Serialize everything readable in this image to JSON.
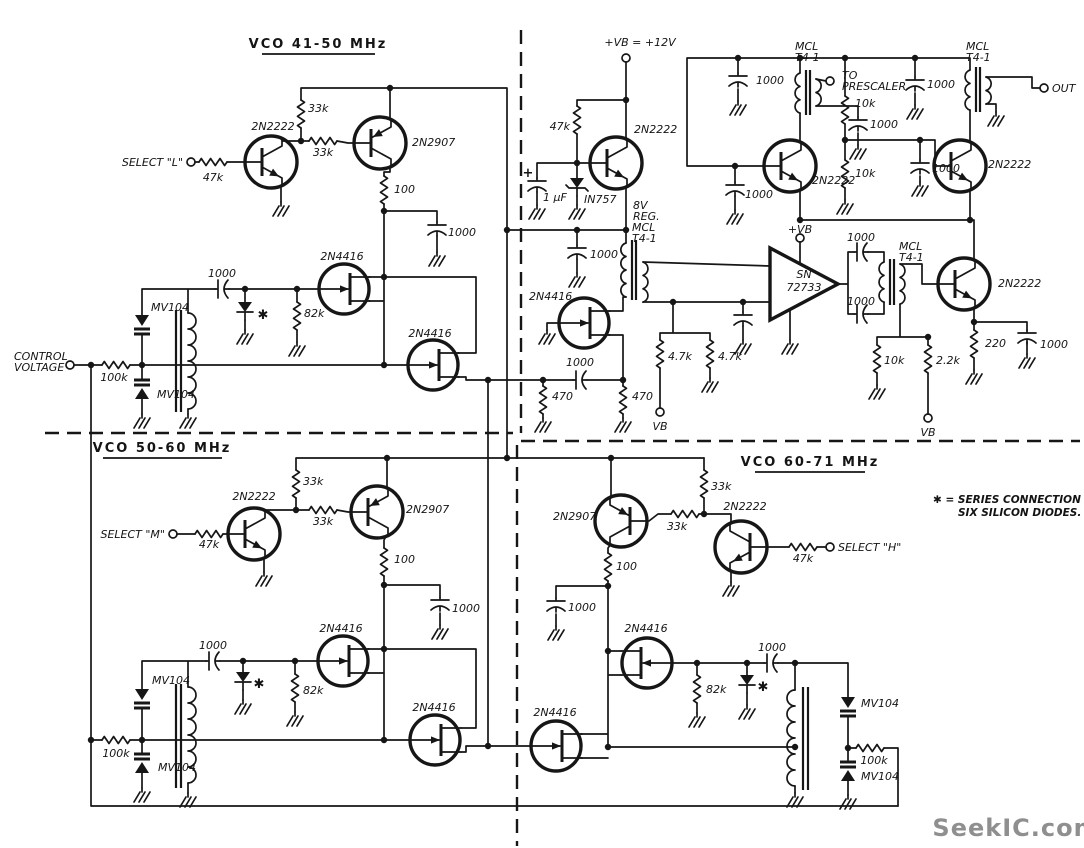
{
  "diagram": {
    "type": "schematic",
    "description": "Three-range VCO circuit schematic (41-50 MHz, 50-60 MHz, 60-71 MHz) with buffer/output stages",
    "watermark_color": "#8f8f8f",
    "ink_color": "#161616"
  },
  "labels": [
    {
      "n": "vco1-title",
      "t": "VCO   41-50 MHz",
      "x": 318,
      "y": 48,
      "a": "m",
      "c": "title"
    },
    {
      "n": "vco2-title",
      "t": "VCO   50-60 MHz",
      "x": 162,
      "y": 452,
      "a": "m",
      "c": "title"
    },
    {
      "n": "vco3-title",
      "t": "VCO   60-71 MHz",
      "x": 810,
      "y": 466,
      "a": "m",
      "c": "title"
    },
    {
      "n": "note-line1",
      "t": "✱ = SERIES CONNECTION OF",
      "x": 933,
      "y": 503,
      "c": "note"
    },
    {
      "n": "note-line2",
      "t": "SIX SILICON DIODES.",
      "x": 958,
      "y": 516,
      "c": "note"
    },
    {
      "n": "select-l-label",
      "t": "SELECT \"L\"",
      "x": 183,
      "y": 166,
      "a": "e"
    },
    {
      "n": "select-m-label",
      "t": "SELECT \"M\"",
      "x": 165,
      "y": 538,
      "a": "e"
    },
    {
      "n": "select-h-label",
      "t": "SELECT \"H\"",
      "x": 838,
      "y": 551
    },
    {
      "n": "control-voltage-line1",
      "t": "CONTROL",
      "x": 14,
      "y": 360
    },
    {
      "n": "control-voltage-line2",
      "t": "VOLTAGE",
      "x": 14,
      "y": 371
    },
    {
      "n": "to-prescaler-line1",
      "t": "TO",
      "x": 842,
      "y": 79
    },
    {
      "n": "to-prescaler-line2",
      "t": "PRESCALER",
      "x": 842,
      "y": 90
    },
    {
      "n": "out-label",
      "t": "OUT",
      "x": 1052,
      "y": 92
    },
    {
      "n": "supply-label",
      "t": "+VB = +12V",
      "x": 640,
      "y": 46,
      "a": "m"
    },
    {
      "n": "opamp-vb-label",
      "t": "+VB",
      "x": 800,
      "y": 233,
      "a": "m"
    },
    {
      "n": "vb-label-1",
      "t": "VB",
      "x": 660,
      "y": 430,
      "a": "m"
    },
    {
      "n": "vb-label-2",
      "t": "VB",
      "x": 928,
      "y": 436,
      "a": "m"
    },
    {
      "n": "reg-label-line1",
      "t": "8V",
      "x": 633,
      "y": 209
    },
    {
      "n": "reg-label-line2",
      "t": "REG.",
      "x": 633,
      "y": 220
    },
    {
      "n": "r-47k-vco1",
      "t": "47k",
      "x": 213,
      "y": 181,
      "a": "m"
    },
    {
      "n": "q-2n2222-vco1",
      "t": "2N2222",
      "x": 273,
      "y": 130,
      "a": "m"
    },
    {
      "n": "r-33k-a-vco1",
      "t": "33k",
      "x": 308,
      "y": 112
    },
    {
      "n": "r-33k-b-vco1",
      "t": "33k",
      "x": 323,
      "y": 156,
      "a": "m"
    },
    {
      "n": "q-2n2907-vco1",
      "t": "2N2907",
      "x": 412,
      "y": 146
    },
    {
      "n": "r-100-vco1",
      "t": "100",
      "x": 394,
      "y": 193
    },
    {
      "n": "c-1000-a-vco1",
      "t": "1000",
      "x": 448,
      "y": 236
    },
    {
      "n": "q-2n4416-a-vco1",
      "t": "2N4416",
      "x": 342,
      "y": 260,
      "a": "m"
    },
    {
      "n": "r-82k-vco1",
      "t": "82k",
      "x": 304,
      "y": 317
    },
    {
      "n": "c-1000-b-vco1",
      "t": "1000",
      "x": 222,
      "y": 277,
      "a": "m"
    },
    {
      "n": "star-vco1",
      "t": "✱",
      "x": 263,
      "y": 319,
      "a": "m",
      "c": "star"
    },
    {
      "n": "d-mv104-a-vco1",
      "t": "MV104",
      "x": 151,
      "y": 311
    },
    {
      "n": "d-mv104-b-vco1",
      "t": "MV104",
      "x": 157,
      "y": 398
    },
    {
      "n": "r-100k-vco1",
      "t": "100k",
      "x": 114,
      "y": 381,
      "a": "m"
    },
    {
      "n": "q-2n4416-b-vco1",
      "t": "2N4416",
      "x": 430,
      "y": 337,
      "a": "m"
    },
    {
      "n": "r-47k-reg",
      "t": "47k",
      "x": 570,
      "y": 130,
      "a": "e"
    },
    {
      "n": "q-2n2222-reg",
      "t": "2N2222",
      "x": 634,
      "y": 133
    },
    {
      "n": "c-1uf-label",
      "t": "1 μF",
      "x": 543,
      "y": 201
    },
    {
      "n": "plus-1uf",
      "t": "+",
      "x": 528,
      "y": 177,
      "a": "m",
      "c": "star"
    },
    {
      "n": "d-1n757",
      "t": "IN757",
      "x": 584,
      "y": 203
    },
    {
      "n": "t4-mid-line1",
      "t": "MCL",
      "x": 632,
      "y": 231
    },
    {
      "n": "t4-mid-line2",
      "t": "T4-1",
      "x": 632,
      "y": 242
    },
    {
      "n": "c-1000-reg",
      "t": "1000",
      "x": 590,
      "y": 258
    },
    {
      "n": "q-2n4416-buffer",
      "t": "2N4416",
      "x": 529,
      "y": 300
    },
    {
      "n": "c-1000-couple",
      "t": "1000",
      "x": 580,
      "y": 366,
      "a": "m"
    },
    {
      "n": "r-470-a",
      "t": "470",
      "x": 552,
      "y": 400
    },
    {
      "n": "r-470-b",
      "t": "470",
      "x": 632,
      "y": 400
    },
    {
      "n": "r-4p7k-a",
      "t": "4.7k",
      "x": 668,
      "y": 360
    },
    {
      "n": "r-4p7k-b",
      "t": "4.7k",
      "x": 718,
      "y": 360
    },
    {
      "n": "opamp-line1",
      "t": "SN",
      "x": 804,
      "y": 278,
      "a": "m"
    },
    {
      "n": "opamp-line2",
      "t": "72733",
      "x": 804,
      "y": 291,
      "a": "m"
    },
    {
      "n": "c-1000-fb-top",
      "t": "1000",
      "x": 861,
      "y": 241,
      "a": "m"
    },
    {
      "n": "c-1000-fb-bot",
      "t": "1000",
      "x": 861,
      "y": 305,
      "a": "m"
    },
    {
      "n": "t4-out2-line1",
      "t": "MCL",
      "x": 899,
      "y": 250
    },
    {
      "n": "t4-out2-line2",
      "t": "T4-1",
      "x": 899,
      "y": 261
    },
    {
      "n": "q-2n2222-out",
      "t": "2N2222",
      "x": 998,
      "y": 287
    },
    {
      "n": "r-220",
      "t": "220",
      "x": 985,
      "y": 347
    },
    {
      "n": "c-1000-out",
      "t": "1000",
      "x": 1040,
      "y": 348
    },
    {
      "n": "r-10k-bias",
      "t": "10k",
      "x": 884,
      "y": 364
    },
    {
      "n": "r-2p2k",
      "t": "2.2k",
      "x": 936,
      "y": 364
    },
    {
      "n": "r-10k-a",
      "t": "10k",
      "x": 855,
      "y": 107
    },
    {
      "n": "r-10k-b",
      "t": "10k",
      "x": 855,
      "y": 177
    },
    {
      "n": "c-1000-rail",
      "t": "1000",
      "x": 756,
      "y": 84
    },
    {
      "n": "t4-presc-line1",
      "t": "MCL",
      "x": 795,
      "y": 50
    },
    {
      "n": "t4-presc-line2",
      "t": "T4-1",
      "x": 795,
      "y": 61
    },
    {
      "n": "c-1000-presc",
      "t": "1000",
      "x": 870,
      "y": 128
    },
    {
      "n": "c-1000-top",
      "t": "1000",
      "x": 927,
      "y": 88
    },
    {
      "n": "q-2n2222-buf1",
      "t": "2N2222",
      "x": 812,
      "y": 184
    },
    {
      "n": "c-1000-buf2",
      "t": "1000",
      "x": 932,
      "y": 172
    },
    {
      "n": "c-1000-buf1",
      "t": "1000",
      "x": 745,
      "y": 198
    },
    {
      "n": "q-2n2222-buf2",
      "t": "2N2222",
      "x": 988,
      "y": 168
    },
    {
      "n": "t4-out-line1",
      "t": "MCL",
      "x": 966,
      "y": 50
    },
    {
      "n": "t4-out-line2",
      "t": "T4-1",
      "x": 966,
      "y": 61
    },
    {
      "n": "q-2n2222-vco2",
      "t": "2N2222",
      "x": 254,
      "y": 500,
      "a": "m"
    },
    {
      "n": "r-47k-vco2",
      "t": "47k",
      "x": 209,
      "y": 548,
      "a": "m"
    },
    {
      "n": "r-33k-a-vco2",
      "t": "33k",
      "x": 303,
      "y": 485
    },
    {
      "n": "r-33k-b-vco2",
      "t": "33k",
      "x": 323,
      "y": 525,
      "a": "m"
    },
    {
      "n": "q-2n2907-vco2",
      "t": "2N2907",
      "x": 406,
      "y": 513
    },
    {
      "n": "r-100-vco2",
      "t": "100",
      "x": 394,
      "y": 563
    },
    {
      "n": "c-1000-a-vco2",
      "t": "1000",
      "x": 452,
      "y": 612
    },
    {
      "n": "q-2n4416-a-vco2",
      "t": "2N4416",
      "x": 341,
      "y": 632,
      "a": "m"
    },
    {
      "n": "c-1000-b-vco2",
      "t": "1000",
      "x": 213,
      "y": 649,
      "a": "m"
    },
    {
      "n": "r-82k-vco2",
      "t": "82k",
      "x": 303,
      "y": 694
    },
    {
      "n": "star-vco2",
      "t": "✱",
      "x": 259,
      "y": 688,
      "a": "m",
      "c": "star"
    },
    {
      "n": "d-mv104-a-vco2",
      "t": "MV104",
      "x": 152,
      "y": 684
    },
    {
      "n": "d-mv104-b-vco2",
      "t": "MV104",
      "x": 158,
      "y": 771
    },
    {
      "n": "r-100k-vco2",
      "t": "100k",
      "x": 116,
      "y": 757,
      "a": "m"
    },
    {
      "n": "q-2n4416-b-vco2",
      "t": "2N4416",
      "x": 434,
      "y": 711,
      "a": "m"
    },
    {
      "n": "q-2n2907-vco3",
      "t": "2N2907",
      "x": 553,
      "y": 520
    },
    {
      "n": "r-33k-a-vco3",
      "t": "33k",
      "x": 711,
      "y": 490
    },
    {
      "n": "r-33k-b-vco3",
      "t": "33k",
      "x": 677,
      "y": 530,
      "a": "m"
    },
    {
      "n": "q-2n2222-vco3",
      "t": "2N2222",
      "x": 745,
      "y": 510,
      "a": "m"
    },
    {
      "n": "r-47k-vco3",
      "t": "47k",
      "x": 803,
      "y": 562,
      "a": "m"
    },
    {
      "n": "r-100-vco3",
      "t": "100",
      "x": 616,
      "y": 570
    },
    {
      "n": "c-1000-a-vco3",
      "t": "1000",
      "x": 568,
      "y": 611
    },
    {
      "n": "q-2n4416-a-vco3",
      "t": "2N4416",
      "x": 646,
      "y": 632,
      "a": "m"
    },
    {
      "n": "r-82k-vco3",
      "t": "82k",
      "x": 706,
      "y": 693
    },
    {
      "n": "star-vco3",
      "t": "✱",
      "x": 763,
      "y": 691,
      "a": "m",
      "c": "star"
    },
    {
      "n": "c-1000-b-vco3",
      "t": "1000",
      "x": 772,
      "y": 651,
      "a": "m"
    },
    {
      "n": "d-mv104-a-vco3",
      "t": "MV104",
      "x": 861,
      "y": 707
    },
    {
      "n": "r-100k-vco3",
      "t": "100k",
      "x": 874,
      "y": 764,
      "a": "m"
    },
    {
      "n": "d-mv104-b-vco3",
      "t": "MV104",
      "x": 861,
      "y": 780
    },
    {
      "n": "q-2n4416-b-vco3",
      "t": "2N4416",
      "x": 555,
      "y": 716,
      "a": "m"
    },
    {
      "n": "watermark",
      "t": "SeekIC.com",
      "x": 1016,
      "y": 836,
      "a": "m",
      "c": "wm"
    }
  ]
}
